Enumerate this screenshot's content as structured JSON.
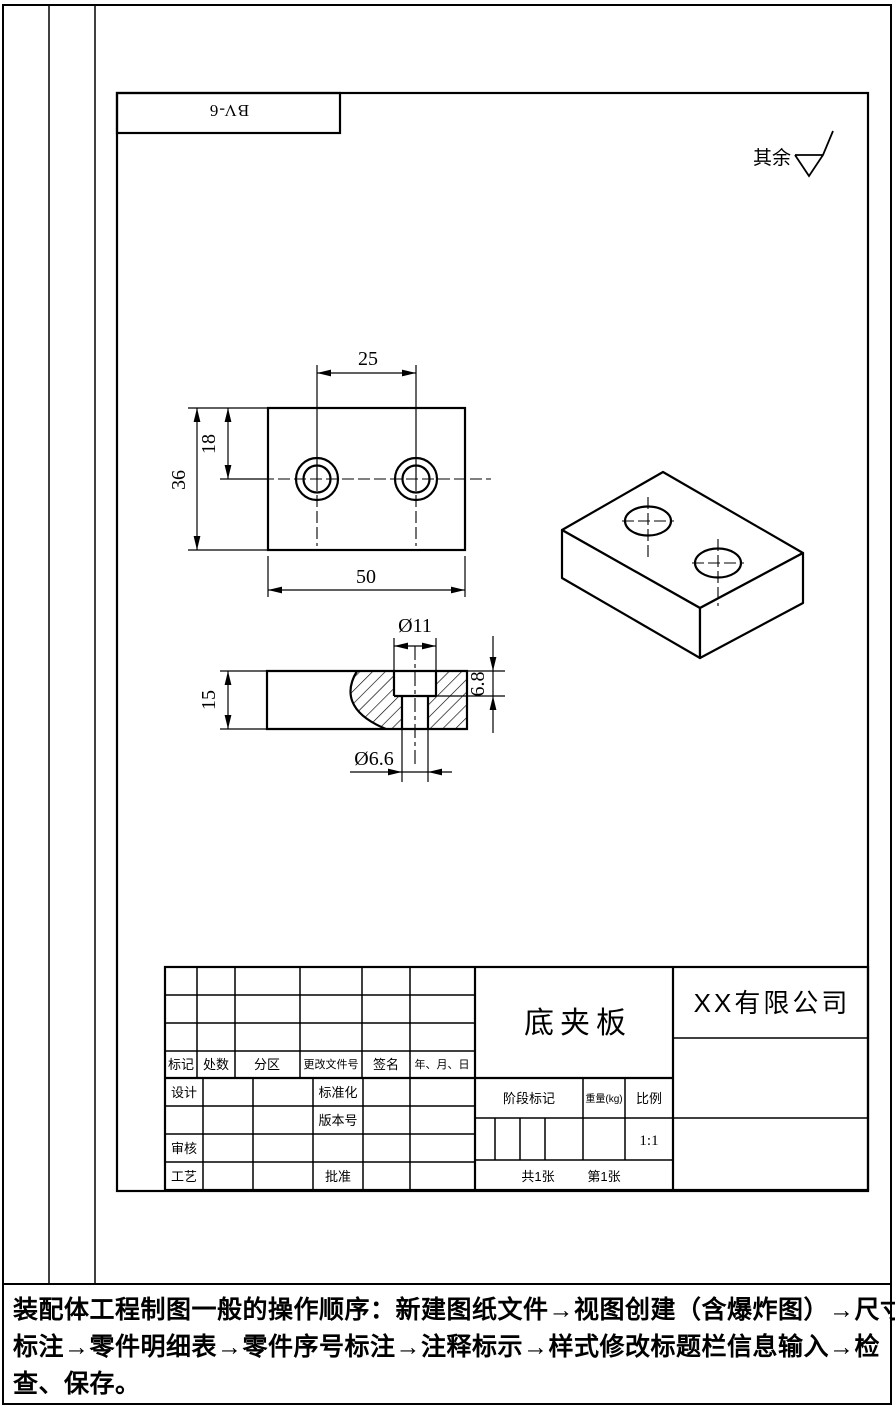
{
  "frame": {
    "bv_label": "BV-6",
    "surface_note_label": "其余"
  },
  "views": {
    "front": {
      "dim_hole_spacing": "25",
      "dim_hole_offset": "18",
      "dim_height": "36",
      "dim_width": "50"
    },
    "section": {
      "dim_counterbore_dia": "Ø11",
      "dim_counterbore_depth": "6.8",
      "dim_thickness": "15",
      "dim_hole_dia": "Ø6.6"
    }
  },
  "title_block": {
    "revision_headers": [
      "标记",
      "处数",
      "分区",
      "更改文件号",
      "签名",
      "年、月、日"
    ],
    "labels": {
      "design": "设计",
      "standardize": "标准化",
      "version": "版本号",
      "audit": "审核",
      "process": "工艺",
      "approve": "批准",
      "stage_mark": "阶段标记",
      "weight": "重量(kg)",
      "scale": "比例"
    },
    "part_name": "底夹板",
    "company": "XX有限公司",
    "scale_value": "1:1",
    "sheet_total": "共1张",
    "sheet_no": "第1张"
  },
  "footer": {
    "lines": [
      "装配体工程制图一般的操作顺序：新建图纸文件→视图创建（含爆炸图）→尺寸",
      "标注→零件明细表→零件序号标注→注释标示→样式修改标题栏信息输入→检",
      "查、保存。"
    ]
  }
}
